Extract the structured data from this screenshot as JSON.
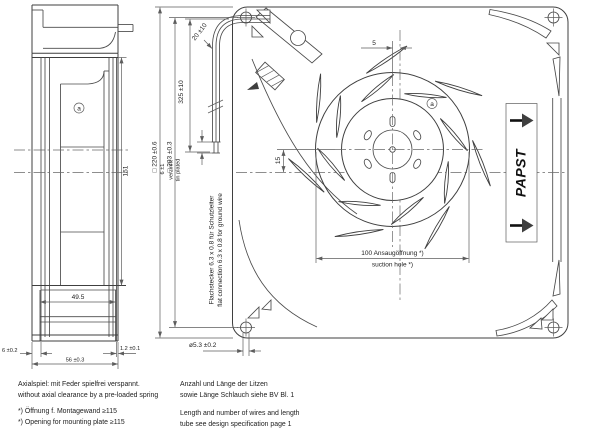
{
  "side_view": {
    "dims": {
      "d151": "151",
      "d49_5": "49.5",
      "d56": "56 ±0.3",
      "d6": "6 ±0.2",
      "d1_2": "1.2 ±0.1"
    },
    "balance_mark": "a"
  },
  "front_view": {
    "dims": {
      "d220": "□ 220 ±0.6",
      "d203": "□ 203 ±0.3",
      "d325": "325 ±10",
      "d20": "20 ±10",
      "d6": "6 ±1",
      "d5": "5",
      "d15": "15",
      "d100_de": "100 Ansaugöffnung *)",
      "d100_en": "suction hole *)",
      "d5_3": "ø5.3 ±0.2"
    },
    "labels": {
      "tinned_de": "verzinnt",
      "tinned_en": "tin plated",
      "connector_de": "Flachstecker 6.3 x 0.8 für Schutzleiter",
      "connector_en": "flat connection 6.3 x 0.8 for ground wire"
    },
    "brand": "PAPST",
    "balance_mark": "a"
  },
  "notes": {
    "axial_de": "Axialspiel: mit Feder spielfrei verspannt.",
    "axial_en": "without axial clearance by a pre-loaded spring",
    "opening_de": "*) Öffnung f. Montagewand ≥115",
    "opening_en": "*) Opening for mounting plate ≥115",
    "wires_de1": "Anzahl und Länge der Litzen",
    "wires_de2": "sowie Länge Schlauch siehe BV Bl. 1",
    "wires_en1": "Length and number of wires and length",
    "wires_en2": "tube see design specification page 1"
  },
  "colors": {
    "line": "#3f3f3f",
    "dim": "#5d5d5d",
    "text": "#222222",
    "brand": "#111111"
  }
}
